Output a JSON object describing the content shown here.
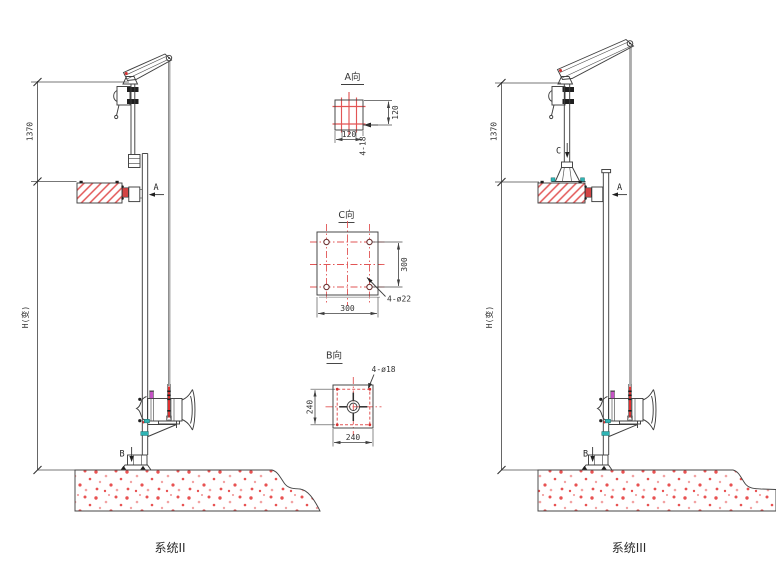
{
  "systems": [
    {
      "caption": "系统II",
      "dims": {
        "upper": "1370",
        "total": "H(变)"
      },
      "section_markers": {
        "a": "A",
        "b": "B"
      }
    },
    {
      "caption": "系统III",
      "dims": {
        "upper": "1370",
        "total": "H(变)"
      },
      "section_markers": {
        "a": "A",
        "b": "B",
        "c": "C"
      }
    }
  ],
  "details": [
    {
      "title": "A向",
      "dim_width": "120",
      "dim_height": "120",
      "holes_label": "4-18"
    },
    {
      "title": "C向",
      "dim_width": "300",
      "dim_height": "300",
      "holes_label": "4-ø22"
    },
    {
      "title": "B向",
      "dim_width": "240",
      "dim_height": "240",
      "holes_label": "4-ø18"
    }
  ],
  "colors": {
    "line": "#3f3f3f",
    "centerline_red": "#e25555",
    "hatch_red": "#e25555",
    "concrete_speckle": "#e85252",
    "valve_red": "#d24545",
    "magenta_accent": "#c653c6",
    "cyan_accent": "#2fb3b3"
  }
}
